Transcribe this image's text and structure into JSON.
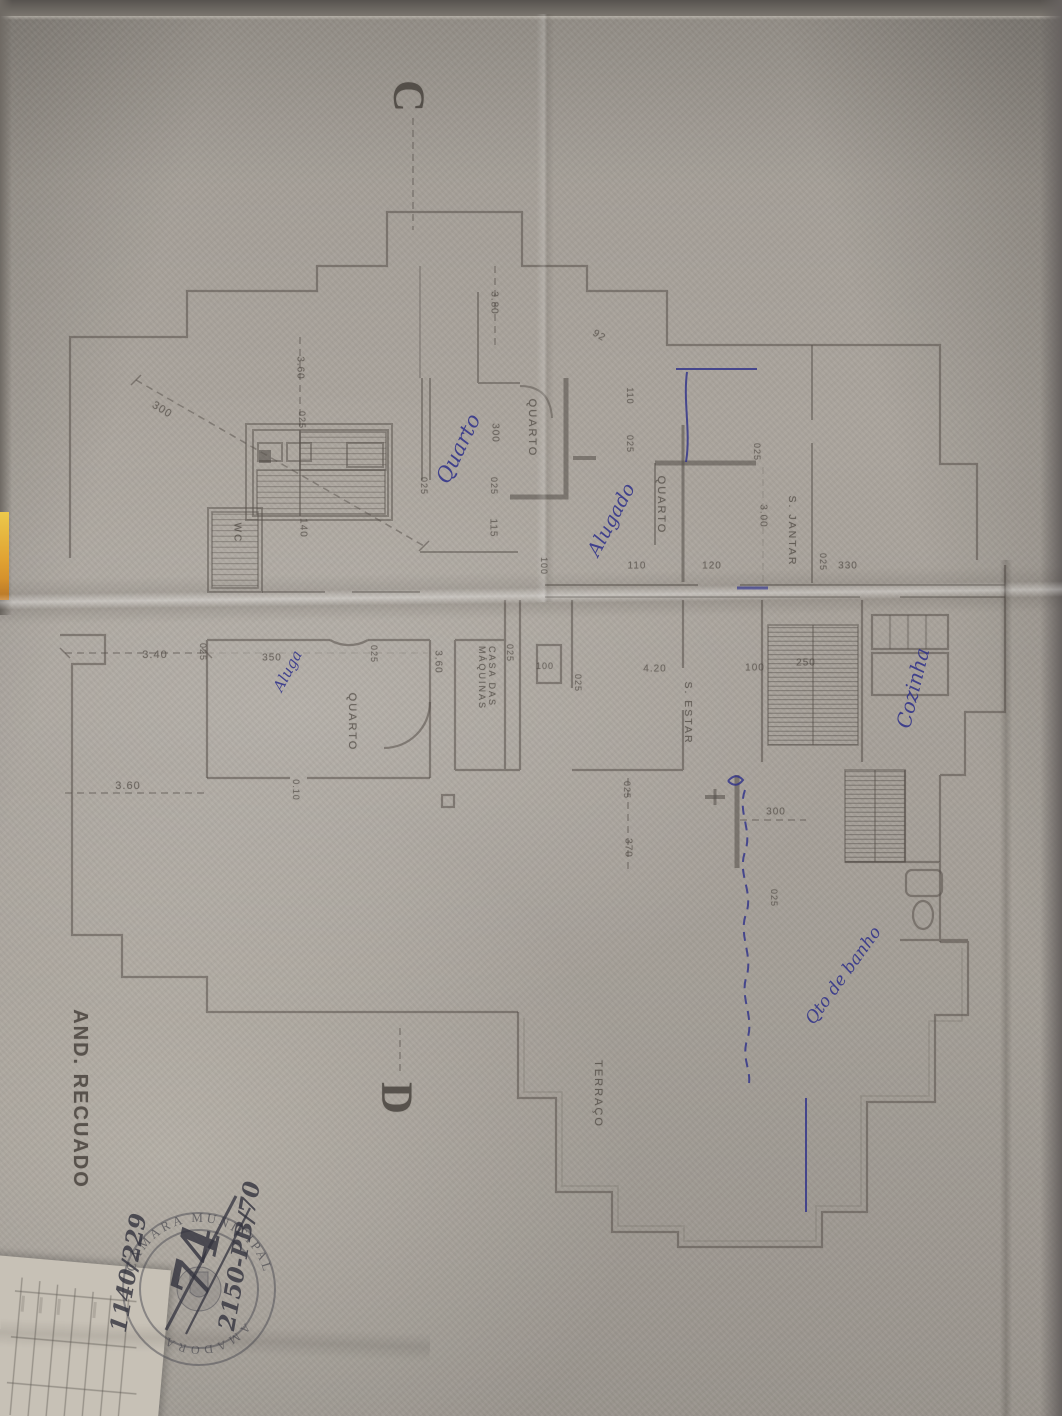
{
  "stamp": {
    "top_text": "CÂMARA MUNICIPAL",
    "bottom_text": "AMADORA"
  },
  "colors": {
    "pencil": "#57514b",
    "ink_blue": "#2d2f8a",
    "stamp_gray": "#4a4a52",
    "paper": "#aba59d",
    "yellow_edge": "#e0a232"
  },
  "annotations": [
    {
      "name": "section-marker-c",
      "cls": "marker",
      "text": "C",
      "x": 409,
      "y": 96,
      "rot": 90,
      "size": 44
    },
    {
      "name": "section-marker-d",
      "cls": "marker",
      "text": "D",
      "x": 397,
      "y": 1098,
      "rot": 90,
      "size": 44
    },
    {
      "name": "room-label-quarto-1",
      "cls": "room",
      "text": "QUARTO",
      "x": 532,
      "y": 428,
      "rot": 90,
      "size": 11
    },
    {
      "name": "room-label-quarto-2",
      "cls": "room",
      "text": "QUARTO",
      "x": 661,
      "y": 505,
      "rot": 90,
      "size": 11
    },
    {
      "name": "room-label-s-jantar",
      "cls": "room",
      "text": "S. JANTAR",
      "x": 791,
      "y": 531,
      "rot": 90,
      "size": 10.5
    },
    {
      "name": "room-label-s-estar",
      "cls": "room",
      "text": "S. ESTAR",
      "x": 687,
      "y": 713,
      "rot": 90,
      "size": 10.5
    },
    {
      "name": "room-label-quarto-3",
      "cls": "room",
      "text": "QUARTO",
      "x": 352,
      "y": 722,
      "rot": 90,
      "size": 11
    },
    {
      "name": "room-label-wc",
      "cls": "room",
      "text": "WC",
      "x": 237,
      "y": 533,
      "rot": 90,
      "size": 10
    },
    {
      "name": "room-label-casa-das-maquinas",
      "cls": "room",
      "text": "CASA DAS\nMÁQUINAS",
      "x": 487,
      "y": 678,
      "rot": 90,
      "size": 9
    },
    {
      "name": "room-label-terraco",
      "cls": "room",
      "text": "TERRAÇO",
      "x": 598,
      "y": 1094,
      "rot": 90,
      "size": 11
    },
    {
      "name": "drawing-title-and-recuado",
      "cls": "title",
      "text": "AND. RECUADO",
      "x": 80,
      "y": 1099,
      "rot": 90,
      "size": 20
    },
    {
      "name": "dim-300-diagonal",
      "cls": "dim",
      "text": "300",
      "x": 162,
      "y": 410,
      "rot": 32,
      "size": 11
    },
    {
      "name": "dim-360-top",
      "cls": "dim",
      "text": "3.60",
      "x": 300,
      "y": 368,
      "rot": 90,
      "size": 10
    },
    {
      "name": "dim-025-a",
      "cls": "dim",
      "text": "025",
      "x": 302,
      "y": 420,
      "rot": 90,
      "size": 9
    },
    {
      "name": "dim-380",
      "cls": "dim",
      "text": "3.80",
      "x": 494,
      "y": 303,
      "rot": 90,
      "size": 10
    },
    {
      "name": "dim-300-b",
      "cls": "dim",
      "text": "300",
      "x": 495,
      "y": 433,
      "rot": 90,
      "size": 10
    },
    {
      "name": "dim-025-b",
      "cls": "dim",
      "text": "025",
      "x": 494,
      "y": 486,
      "rot": 90,
      "size": 9
    },
    {
      "name": "dim-115",
      "cls": "dim",
      "text": "115",
      "x": 493,
      "y": 528,
      "rot": 90,
      "size": 10
    },
    {
      "name": "dim-025-c",
      "cls": "dim",
      "text": "025",
      "x": 424,
      "y": 486,
      "rot": 90,
      "size": 9
    },
    {
      "name": "dim-140",
      "cls": "dim",
      "text": "140",
      "x": 303,
      "y": 528,
      "rot": 90,
      "size": 10
    },
    {
      "name": "dim-92",
      "cls": "dim",
      "text": "92",
      "x": 599,
      "y": 336,
      "rot": 32,
      "size": 10
    },
    {
      "name": "dim-110-a",
      "cls": "dim",
      "text": "110",
      "x": 630,
      "y": 396,
      "rot": 90,
      "size": 9
    },
    {
      "name": "dim-025-d",
      "cls": "dim",
      "text": "025",
      "x": 630,
      "y": 444,
      "rot": 90,
      "size": 9
    },
    {
      "name": "dim-100-a",
      "cls": "dim",
      "text": "100",
      "x": 544,
      "y": 566,
      "rot": 90,
      "size": 9
    },
    {
      "name": "dim-110-b",
      "cls": "dim",
      "text": "110",
      "x": 637,
      "y": 566,
      "rot": 0,
      "size": 10
    },
    {
      "name": "dim-120",
      "cls": "dim",
      "text": "120",
      "x": 712,
      "y": 566,
      "rot": 0,
      "size": 10
    },
    {
      "name": "dim-025-e",
      "cls": "dim",
      "text": "025",
      "x": 757,
      "y": 452,
      "rot": 90,
      "size": 9
    },
    {
      "name": "dim-300-c",
      "cls": "dim",
      "text": "3.00",
      "x": 763,
      "y": 516,
      "rot": 90,
      "size": 10
    },
    {
      "name": "dim-025-f",
      "cls": "dim",
      "text": "025",
      "x": 823,
      "y": 562,
      "rot": 90,
      "size": 9
    },
    {
      "name": "dim-330",
      "cls": "dim",
      "text": "330",
      "x": 848,
      "y": 566,
      "rot": 0,
      "size": 10
    },
    {
      "name": "dim-340",
      "cls": "dim",
      "text": "3.40",
      "x": 155,
      "y": 655,
      "rot": 0,
      "size": 11
    },
    {
      "name": "dim-025-g",
      "cls": "dim",
      "text": "025",
      "x": 203,
      "y": 652,
      "rot": 90,
      "size": 9
    },
    {
      "name": "dim-360-left",
      "cls": "dim",
      "text": "3.60",
      "x": 128,
      "y": 786,
      "rot": 0,
      "size": 11
    },
    {
      "name": "dim-350",
      "cls": "dim",
      "text": "350",
      "x": 272,
      "y": 658,
      "rot": 0,
      "size": 10
    },
    {
      "name": "dim-025-h",
      "cls": "dim",
      "text": "025",
      "x": 374,
      "y": 654,
      "rot": 90,
      "size": 9
    },
    {
      "name": "dim-360-mid",
      "cls": "dim",
      "text": "3.60",
      "x": 438,
      "y": 662,
      "rot": 90,
      "size": 10
    },
    {
      "name": "dim-025-i",
      "cls": "dim",
      "text": "025",
      "x": 510,
      "y": 653,
      "rot": 90,
      "size": 9
    },
    {
      "name": "dim-100-b",
      "cls": "dim",
      "text": "100",
      "x": 545,
      "y": 666,
      "rot": 0,
      "size": 9
    },
    {
      "name": "dim-025-j",
      "cls": "dim",
      "text": "025",
      "x": 578,
      "y": 683,
      "rot": 90,
      "size": 9
    },
    {
      "name": "dim-420",
      "cls": "dim",
      "text": "4.20",
      "x": 655,
      "y": 669,
      "rot": 0,
      "size": 10
    },
    {
      "name": "dim-100-c",
      "cls": "dim",
      "text": "100",
      "x": 755,
      "y": 668,
      "rot": 0,
      "size": 10
    },
    {
      "name": "dim-250",
      "cls": "dim",
      "text": "250",
      "x": 806,
      "y": 663,
      "rot": 0,
      "size": 10
    },
    {
      "name": "dim-025-k",
      "cls": "dim",
      "text": "025",
      "x": 627,
      "y": 790,
      "rot": 90,
      "size": 9
    },
    {
      "name": "dim-370",
      "cls": "dim",
      "text": "370",
      "x": 628,
      "y": 848,
      "rot": 90,
      "size": 10
    },
    {
      "name": "dim-300-d",
      "cls": "dim",
      "text": "300",
      "x": 776,
      "y": 812,
      "rot": 0,
      "size": 10
    },
    {
      "name": "dim-025-l",
      "cls": "dim",
      "text": "025",
      "x": 774,
      "y": 898,
      "rot": 90,
      "size": 9
    },
    {
      "name": "dim-010",
      "cls": "dim",
      "text": "0.10",
      "x": 296,
      "y": 790,
      "rot": 90,
      "size": 9
    },
    {
      "name": "handwritten-note-quarto",
      "cls": "ink",
      "text": "Quarto",
      "x": 459,
      "y": 449,
      "rot": -64,
      "size": 21
    },
    {
      "name": "handwritten-note-alugado",
      "cls": "ink",
      "text": "Alugado",
      "x": 612,
      "y": 520,
      "rot": -62,
      "size": 19
    },
    {
      "name": "handwritten-note-cozinha",
      "cls": "ink",
      "text": "Cozinha",
      "x": 913,
      "y": 688,
      "rot": -76,
      "size": 20
    },
    {
      "name": "handwritten-note-aluga",
      "cls": "ink",
      "text": "Aluga",
      "x": 288,
      "y": 671,
      "rot": -62,
      "size": 15
    },
    {
      "name": "handwritten-note-qto-banho",
      "cls": "ink",
      "text": "Qto de banho",
      "x": 844,
      "y": 976,
      "rot": -54,
      "size": 17
    },
    {
      "name": "stamp-number-2150-pb-70",
      "cls": "ink2",
      "text": "2150-PB/70",
      "x": 240,
      "y": 1256,
      "rot": -80,
      "size": 23
    },
    {
      "name": "stamp-number-1140-229",
      "cls": "ink2",
      "text": "1140/229",
      "x": 129,
      "y": 1273,
      "rot": -80,
      "size": 23
    },
    {
      "name": "stamp-number-74",
      "cls": "ink2",
      "text": "74",
      "x": 197,
      "y": 1262,
      "rot": -78,
      "size": 52
    }
  ]
}
